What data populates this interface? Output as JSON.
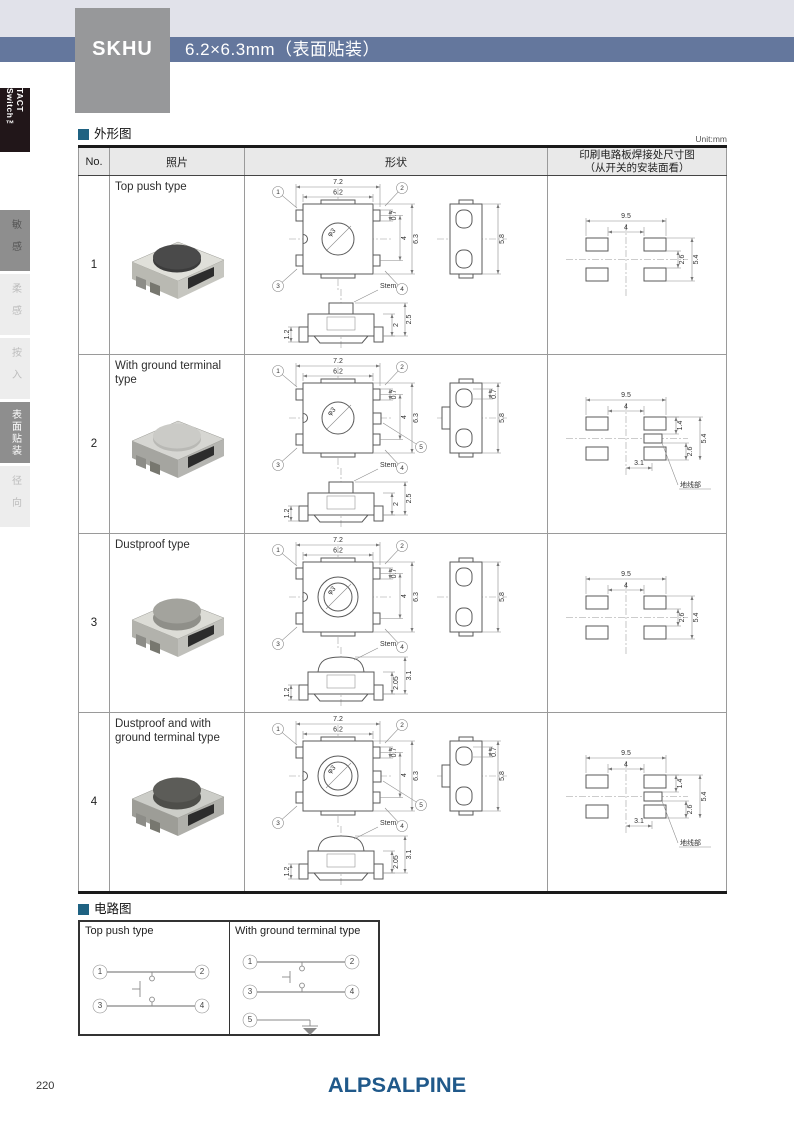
{
  "header": {
    "model": "SKHU",
    "size_label": "6.2×6.3mm（表面贴装）"
  },
  "sidebar": {
    "series_label": "TACT Switch™",
    "tabs": [
      {
        "label": "敏感",
        "state": "graydark"
      },
      {
        "label": "柔感",
        "state": "dim"
      },
      {
        "label": "按入",
        "state": "dim"
      },
      {
        "label": "表面贴装",
        "state": "active"
      },
      {
        "label": "径向",
        "state": "dim"
      }
    ]
  },
  "outline": {
    "title": "外形图",
    "unit": "Unit:mm",
    "columns": {
      "no": "No.",
      "photo": "照片",
      "shape": "形状",
      "pcb_line1": "印刷电路板焊接处尺寸图",
      "pcb_line2": "（从开关的安装面看）"
    },
    "rows": [
      {
        "no": "1",
        "type": "Top push type",
        "ground": false,
        "dome": false,
        "top": {
          "w_outer": "7.2",
          "w_inner": "6.2",
          "dia": "φ3",
          "r1": "0.7",
          "r2": "4",
          "r3": "6.3",
          "pins": [
            "1",
            "2",
            "3",
            "4"
          ]
        },
        "side": {
          "h": "5.8"
        },
        "front": {
          "stem": "Stem",
          "left": "1.2",
          "inner": "2",
          "outer": "2.5"
        },
        "pcb": {
          "w_outer": "9.5",
          "w_inner": "4",
          "r_inner": "2.6",
          "r_outer": "5.4"
        },
        "photo_colors": {
          "body": "#e0e0da",
          "side": "#b9b9b2",
          "button": "#3c3c3c",
          "button_top": "#4a4a4a"
        }
      },
      {
        "no": "2",
        "type": "With ground terminal type",
        "ground": true,
        "dome": false,
        "top": {
          "w_outer": "7.2",
          "w_inner": "6.2",
          "dia": "φ3",
          "r1": "0.7",
          "r2": "4",
          "r3": "6.3",
          "pins": [
            "1",
            "2",
            "3",
            "4",
            "5"
          ]
        },
        "side": {
          "h": "5.8",
          "tab": "0.7"
        },
        "front": {
          "stem": "Stem",
          "left": "1.2",
          "inner": "2",
          "outer": "2.5"
        },
        "pcb": {
          "w_outer": "9.5",
          "w_inner": "4",
          "top_r": "1.4",
          "r_inner": "2.6",
          "r_outer": "5.4",
          "bottom": "3.1",
          "ground_label": "地线部"
        },
        "photo_colors": {
          "body": "#d6d6d2",
          "side": "#a5a5a0",
          "button": "#b9b9b5",
          "button_top": "#cbcbc7"
        }
      },
      {
        "no": "3",
        "type": "Dustproof type",
        "ground": false,
        "dome": true,
        "top": {
          "w_outer": "7.2",
          "w_inner": "6.2",
          "dia": "φ3",
          "r1": "0.7",
          "r2": "4",
          "r3": "6.3",
          "pins": [
            "1",
            "2",
            "3",
            "4"
          ]
        },
        "side": {
          "h": "5.8"
        },
        "front": {
          "stem": "Stem",
          "left": "1.2",
          "inner": "2.05",
          "outer": "3.1"
        },
        "pcb": {
          "w_outer": "9.5",
          "w_inner": "4",
          "r_inner": "2.6",
          "r_outer": "5.4"
        },
        "photo_colors": {
          "body": "#dcdcd6",
          "side": "#b2b2ac",
          "button": "#8f8f89",
          "button_top": "#a3a39d"
        }
      },
      {
        "no": "4",
        "type": "Dustproof and with ground terminal type",
        "ground": true,
        "dome": true,
        "top": {
          "w_outer": "7.2",
          "w_inner": "6.2",
          "dia": "φ3",
          "r1": "0.7",
          "r2": "4",
          "r3": "6.3",
          "pins": [
            "1",
            "2",
            "3",
            "4",
            "5"
          ]
        },
        "side": {
          "h": "5.8",
          "tab": "0.7"
        },
        "front": {
          "stem": "Stem",
          "left": "1.2",
          "inner": "2.05",
          "outer": "3.1"
        },
        "pcb": {
          "w_outer": "9.5",
          "w_inner": "4",
          "top_r": "1.4",
          "r_inner": "2.6",
          "r_outer": "5.4",
          "bottom": "3.1",
          "ground_label": "地线部"
        },
        "photo_colors": {
          "body": "#cccdc8",
          "side": "#9d9d97",
          "button": "#4e4e4a",
          "button_top": "#5c5c58"
        }
      }
    ]
  },
  "circuit": {
    "title": "电路图",
    "cells": [
      {
        "title": "Top push type",
        "pins": [
          "1",
          "2",
          "3",
          "4"
        ],
        "ground": false
      },
      {
        "title": "With ground terminal type",
        "pins": [
          "1",
          "2",
          "3",
          "4",
          "5"
        ],
        "ground": true
      }
    ]
  },
  "footer": {
    "page": "220",
    "logo": "ALPSALPINE"
  },
  "colors": {
    "band_blue": "#64779d",
    "band_gray": "#e1e2ea",
    "model_box_gray": "#97989a",
    "section_bullet": "#1f6282",
    "logo_blue": "#20598a",
    "tab_active_bg": "#8e8e8e"
  }
}
